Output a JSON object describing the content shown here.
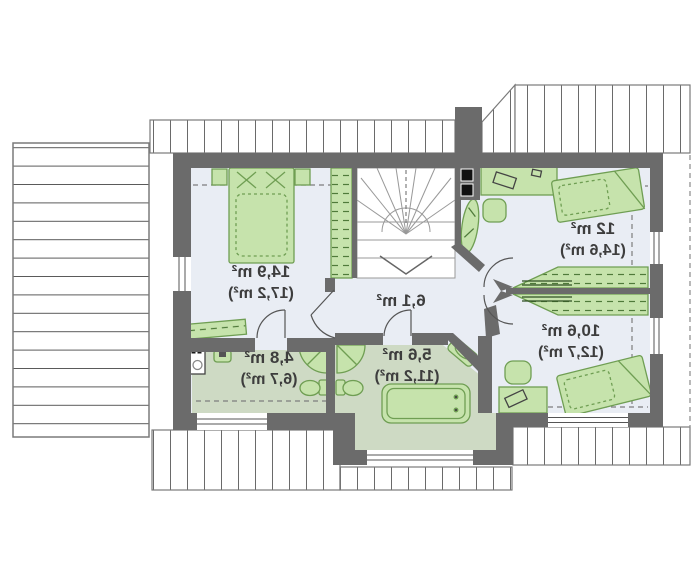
{
  "plan": {
    "title": "attic floor plan",
    "rooms": [
      {
        "id": "bedroom-left",
        "area": "14,9 m²",
        "area_gross": "(17,2 m²)"
      },
      {
        "id": "hall-staircase",
        "area": "6,1 m²",
        "area_gross": ""
      },
      {
        "id": "bedroom-top-right",
        "area": "12 m²",
        "area_gross": "(14,6 m²)"
      },
      {
        "id": "bedroom-bottom-right",
        "area": "10,6 m²",
        "area_gross": "(12,7 m²)"
      },
      {
        "id": "bathroom",
        "area": "5,6 m²",
        "area_gross": "(11,2 m²)"
      },
      {
        "id": "ensuite-bathroom",
        "area": "4,8 m²",
        "area_gross": "(6,7 m²)"
      }
    ],
    "colors": {
      "wall": "#6b6b6b",
      "floor": "#e9edf4",
      "bath_floor": "#cedac4",
      "furniture": "#c6e3ac",
      "furniture_stroke": "#6f9e53",
      "hatch": "#6a6a6a",
      "text": "#3d3d3d"
    }
  }
}
